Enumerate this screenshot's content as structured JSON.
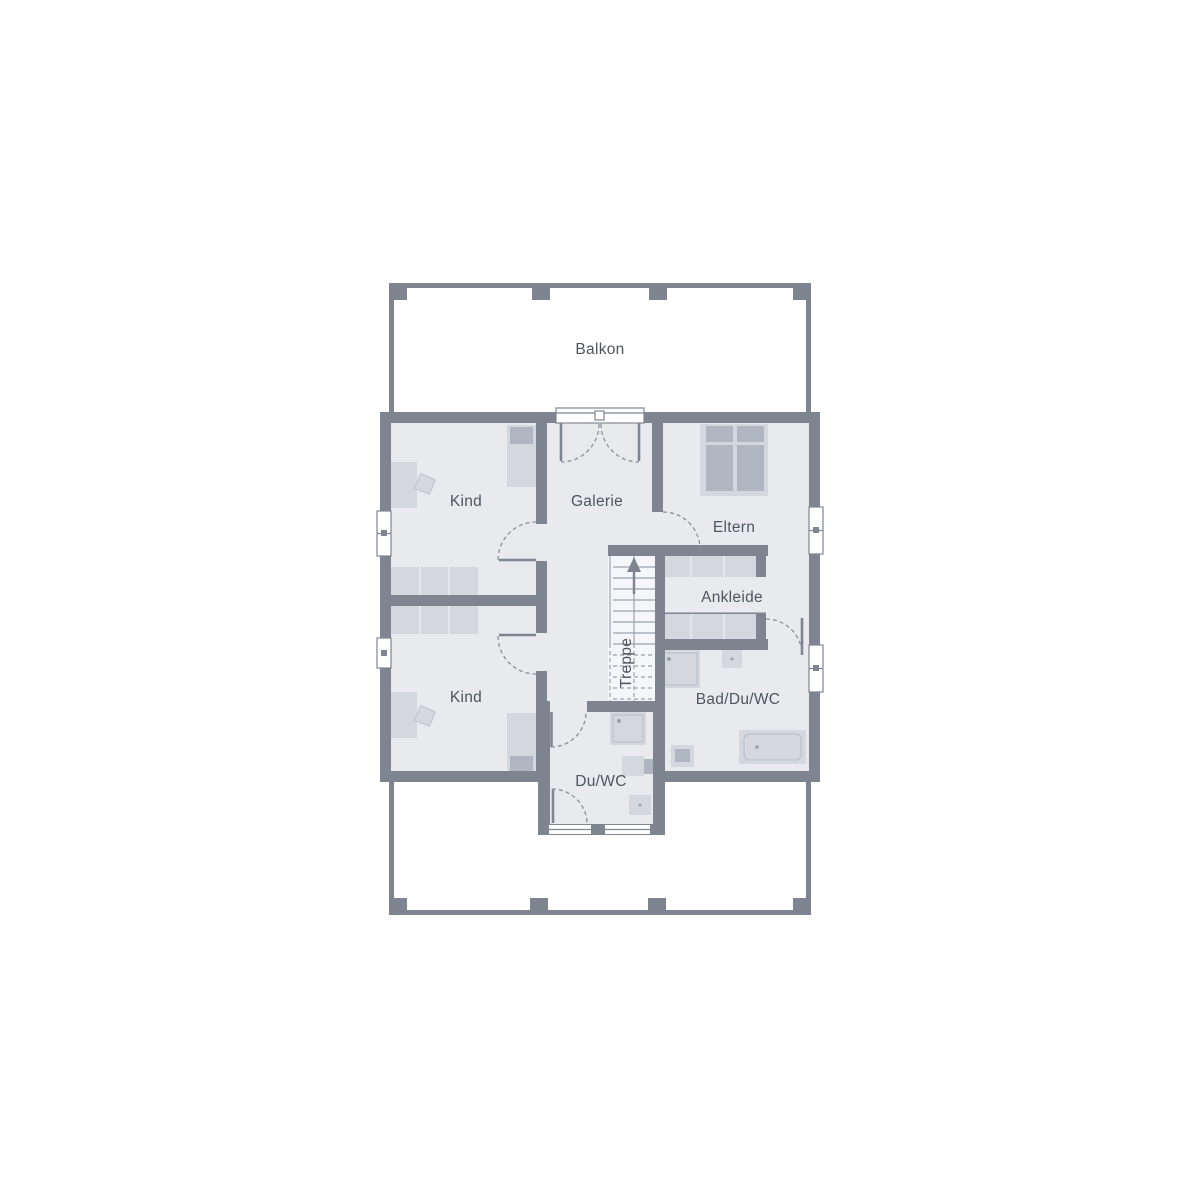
{
  "rooms": {
    "balkon": "Balkon",
    "kind_top": "Kind",
    "galerie": "Galerie",
    "eltern": "Eltern",
    "ankleide": "Ankleide",
    "kind_bottom": "Kind",
    "bad_du_wc": "Bad/Du/WC",
    "du_wc": "Du/WC",
    "treppe": "Treppe"
  },
  "colors": {
    "wall": "#7E8591",
    "floor": "#E8EAEE",
    "furniture_light": "#D4D8DE",
    "furniture_medium": "#AFB6C1",
    "stair_fill": "#F5F6F9",
    "label_text": "#4E555F",
    "background": "#FFFFFF"
  }
}
